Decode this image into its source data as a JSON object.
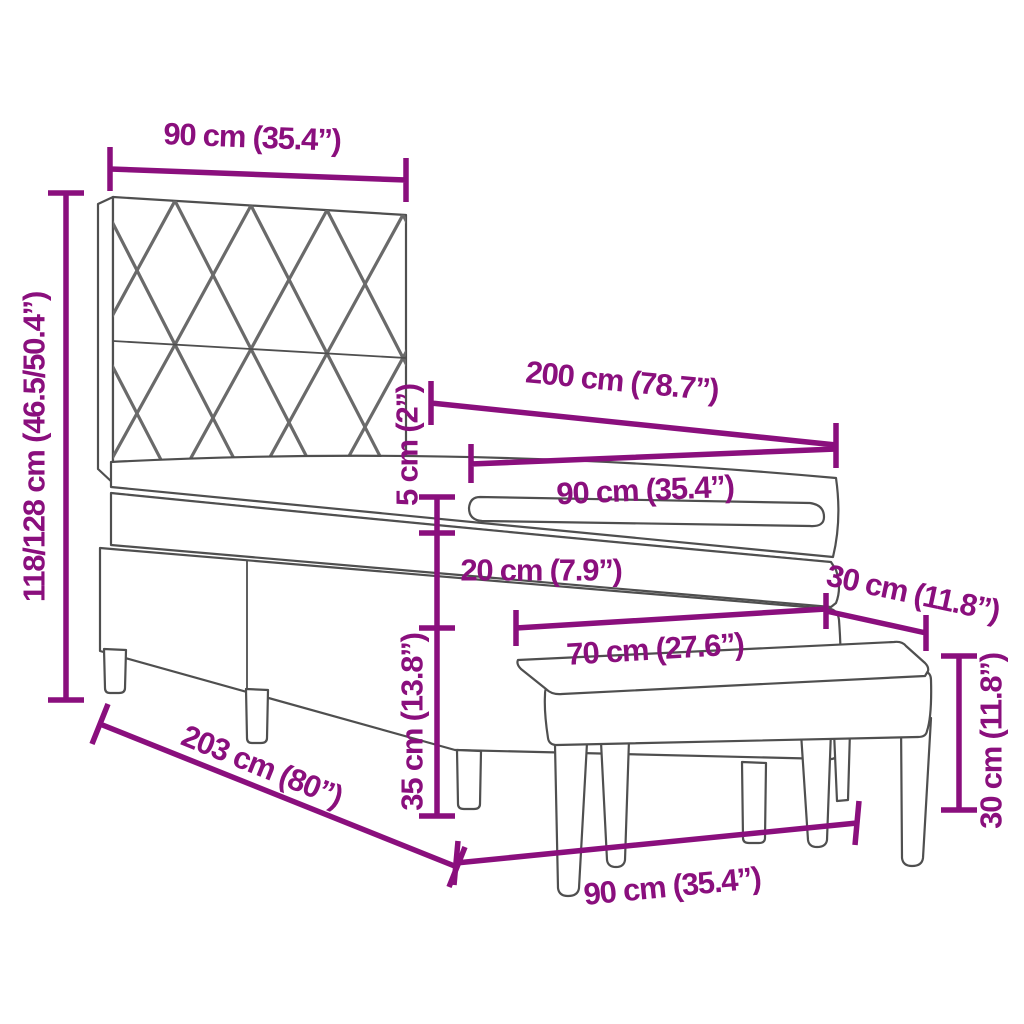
{
  "diagram": {
    "subject": "box spring bed with upholstered headboard, mattress, topper and bench",
    "accent_color": "#8A0F7D",
    "outline_color": "#4f4f4f",
    "background_color": "#ffffff",
    "dimensions": [
      {
        "id": "headboard-width",
        "label": "90 cm (35.4”)"
      },
      {
        "id": "headboard-height",
        "label": "118/128 cm (46.5/50.4”)"
      },
      {
        "id": "mattress-length",
        "label": "200 cm (78.7”)"
      },
      {
        "id": "mattress-width",
        "label": "90 cm (35.4”)"
      },
      {
        "id": "topper-thickness",
        "label": "5 cm (2”)"
      },
      {
        "id": "mattress-thickness",
        "label": "20 cm (7.9”)"
      },
      {
        "id": "base-height",
        "label": "35 cm (13.8”)"
      },
      {
        "id": "bed-length",
        "label": "203 cm (80”)"
      },
      {
        "id": "bed-width",
        "label": "90 cm (35.4”)"
      },
      {
        "id": "bench-depth",
        "label": "30 cm (11.8”)"
      },
      {
        "id": "bench-width",
        "label": "70 cm (27.6”)"
      },
      {
        "id": "bench-height",
        "label": "30 cm (11.8”)"
      }
    ]
  }
}
